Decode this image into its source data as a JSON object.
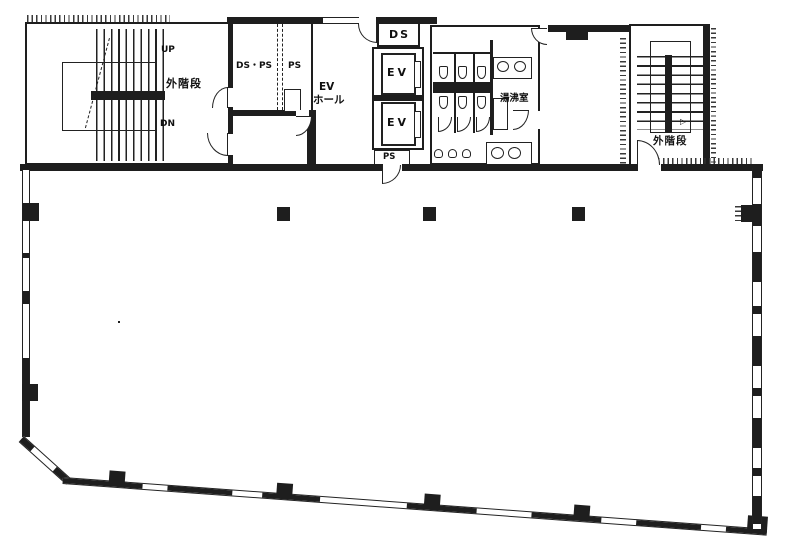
{
  "drawing": {
    "type": "building-floor-plan",
    "colors": {
      "ink": "#1e1e1e",
      "paper": "#ffffff"
    },
    "labels": {
      "left_stair_up": "UP",
      "left_stair_dn": "DN",
      "left_stair_name": "外階段",
      "duct_room": "DS・PS",
      "duct_room_ps": "PS",
      "ev_hall_line1": "EV",
      "ev_hall_line2": "ホール",
      "duct_shaft_top": "DS",
      "elevator_1": "EV",
      "elevator_2": "EV",
      "pipe_space_bottom": "PS",
      "kitchenette": "湯沸室",
      "right_stair_name": "外階段",
      "right_stair_arrow": "▷"
    }
  }
}
